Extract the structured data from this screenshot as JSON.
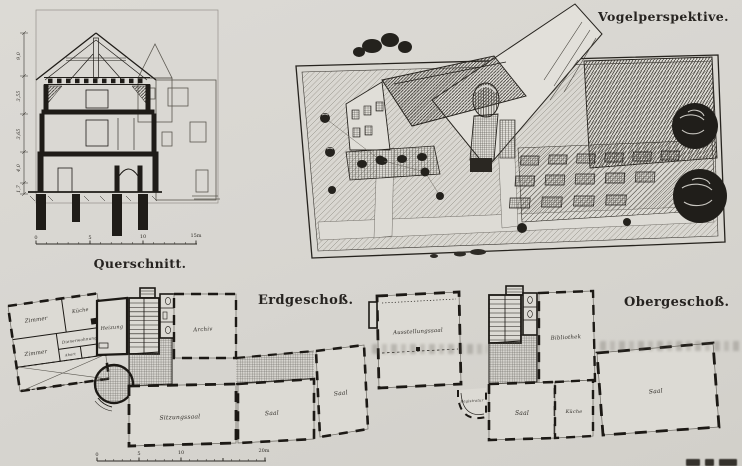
{
  "colors": {
    "paper": "#d8d6d1",
    "ink": "#201d19"
  },
  "titles": {
    "querschnitt": "Querschnitt.",
    "vogelperspektive": "Vogelperspektive.",
    "erdgeschoss": "Erdgeschoß.",
    "obergeschoss": "Obergeschoß."
  },
  "querschnitt": {
    "dim_labels": [
      "9,0",
      "3,55",
      "3,65",
      "4,0",
      "1,7"
    ],
    "scale_labels": [
      "0",
      "5",
      "10",
      "15m"
    ]
  },
  "erdgeschoss": {
    "rooms": {
      "zimmer1": "Zimmer",
      "kueche": "Küche",
      "heizung": "Heizung",
      "zimmer2": "Zimmer",
      "dienerwohnung": "Dienerwohnung",
      "abort": "Abort",
      "archiv": "Archiv",
      "sitzungssaal": "Sitzungssaal",
      "saal_mitte": "Saal",
      "saal_rechts": "Saal"
    },
    "scale_labels": [
      "0",
      "5",
      "10",
      "20m"
    ]
  },
  "obergeschoss": {
    "rooms": {
      "ausstellungssaal": "Ausstellungssaal",
      "bibliothek": "Bibliothek",
      "registratur": "Registratur",
      "saal_links": "Saal",
      "kueche": "Küche",
      "saal_rechts": "Saal"
    }
  }
}
